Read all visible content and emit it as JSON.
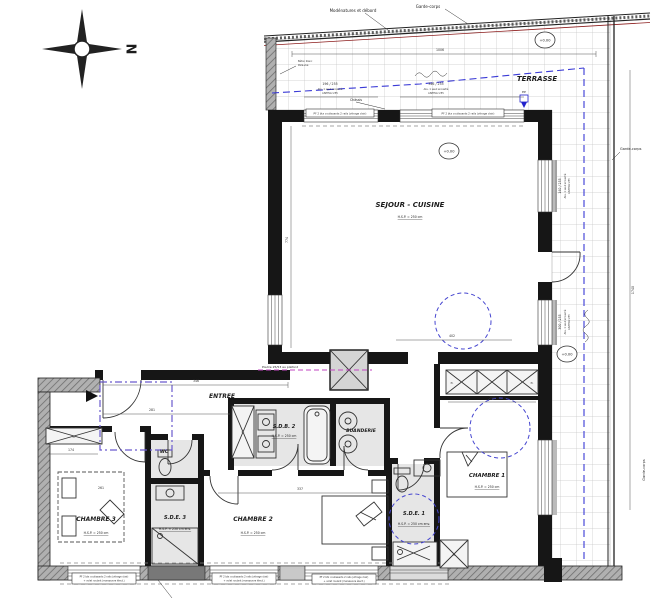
{
  "plan": {
    "compass": "N",
    "colors": {
      "wall": "#161616",
      "blue_dash": "#3a3ad6",
      "magenta_dash": "#c244c2",
      "purple_dash": "#6a5acd",
      "railing_red": "#8c1d1d",
      "bath_floor": "#e6e6e6"
    },
    "rooms": {
      "terrasse": {
        "name": "TERRASSE"
      },
      "sejour": {
        "name": "SEJOUR - CUISINE",
        "hsp": "H.S.P. = 250 cm"
      },
      "entree": {
        "name": "ENTREE"
      },
      "wc": {
        "name": "WC"
      },
      "sdb2": {
        "name": "S.D.B. 2",
        "hsp": "H.S.P. = 250 cm"
      },
      "buanderie": {
        "name": "BUANDERIE"
      },
      "chambre1": {
        "name": "CHAMBRE 1",
        "hsp": "H.S.P. = 250 cm"
      },
      "chambre2": {
        "name": "CHAMBRE 2",
        "hsp": "H.S.P. = 250 cm"
      },
      "chambre3": {
        "name": "CHAMBRE 3",
        "hsp": "H.S.P. = 250 cm"
      },
      "sde1": {
        "name": "S.D.E. 1",
        "hsp": "H.S.P. = 250 cm env."
      },
      "sde3": {
        "name": "S.D.E. 3",
        "hsp": "H.S.P. = 250 cm env."
      }
    },
    "levels": {
      "zero": "+0.00"
    },
    "annotations": {
      "modenatures": "Modénatures et débord",
      "garde_corps": "Garde-corps",
      "beton_line1": "Béton blanc",
      "beton_line2": "Pare-vue",
      "poutre": "Poutre 25/53 au plafond",
      "chassis": "Châssis",
      "ep": "EP",
      "closet": "Pl.",
      "window_note_1": "PF 2 btx coulissants 2 rails (vitrage clair)",
      "window_note_2": "+ volet roulant (manœuvre élect.)",
      "sill_note_1": "ALL. 1 seuil encastré",
      "sill_note_2": "LINTEAU 255"
    },
    "dimensions": {
      "top_terrace": "1006",
      "entree_width": "346",
      "entree_depth": "281",
      "chambre3_width": "261",
      "chambre2_width": "337",
      "closet_row": "258",
      "window_left": "174",
      "sejour_height": "774",
      "sejour_width": "402",
      "terrace_right": "1740",
      "bay_top_left": "196 / 255",
      "bay_top_right": "346 / 255",
      "bay_right_1": "140 / 255",
      "bay_right_2": "300 / 255"
    }
  }
}
